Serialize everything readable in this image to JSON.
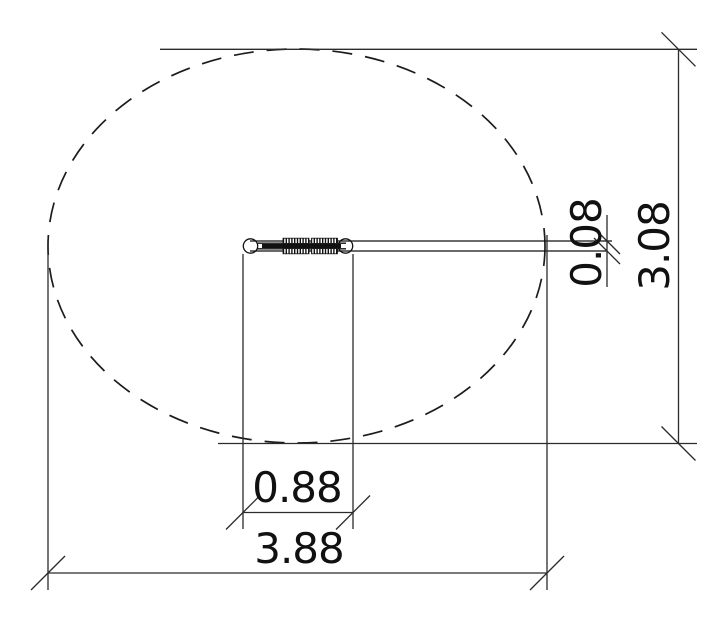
{
  "canvas": {
    "background": "#ffffff",
    "line_color": "#1c1c1c",
    "dim_line_color": "#2b2b2b",
    "text_color": "#111111"
  },
  "drawing": {
    "boundary": {
      "shape": "ellipse",
      "style": "dashed"
    },
    "part": {
      "type": "rod-with-eyelets-and-threaded-sections"
    },
    "dimensions": [
      {
        "id": "part-length",
        "label": "0.88",
        "orientation": "horizontal"
      },
      {
        "id": "overall-width",
        "label": "3.88",
        "orientation": "horizontal"
      },
      {
        "id": "part-thickness",
        "label": "0.08",
        "orientation": "vertical"
      },
      {
        "id": "overall-depth",
        "label": "3.08",
        "orientation": "vertical"
      }
    ]
  }
}
